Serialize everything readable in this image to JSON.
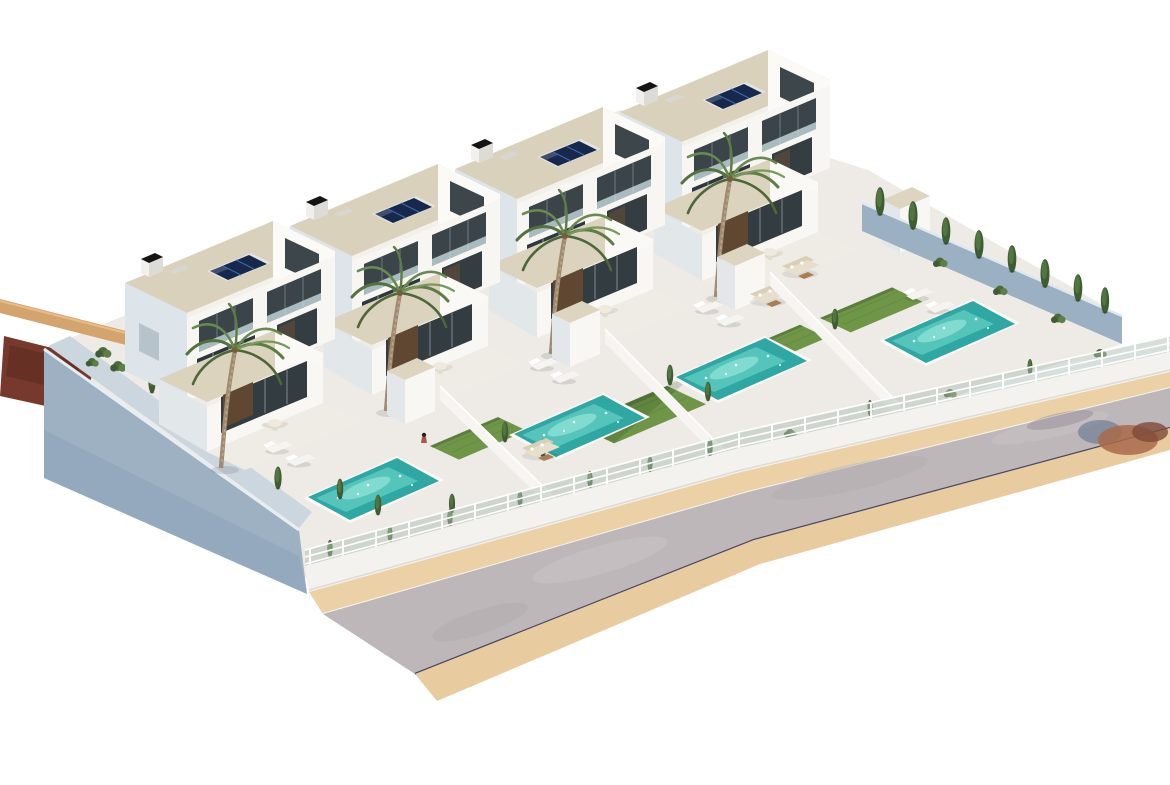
{
  "scene": {
    "type": "3d-architectural-render",
    "description": "Aerial 3D render of a row of four modern white two-storey villas with flat cream roofs, rooftop solar panels, private turquoise pools, lawns, palm trees, cypress hedges, white lattice fences, a blue-grey perimeter wall on the left and an asphalt street with sand-coloured sidewalks in front.",
    "villa_count": 4,
    "pool_count": 4,
    "palm_tree_count": 4,
    "solar_array_per_villa": 1,
    "features": [
      "flat roofs",
      "solar panels",
      "chimneys",
      "private pools",
      "sun loungers",
      "garden sofas",
      "lawns",
      "cypress trees",
      "white fences",
      "street with sidewalks"
    ]
  },
  "palette": {
    "background": "#ffffff",
    "ground": "#eeebe6",
    "roof": "#d9d1bc",
    "wall_sunlit": "#f7f6f2",
    "wall_bright": "#fbfaf7",
    "wall_shadow": "#dde4ea",
    "perimeter_wall_blue": "#9db1c3",
    "inner_wall_blue": "#ccd6df",
    "division_wall": "#f6f5f1",
    "back_wall_blue": "#9bb0c2",
    "front_wall": "#f3f2ee",
    "fence_mesh": "#aebfb3",
    "pool_deep": "#2fa7a3",
    "pool_light": "#6fd8cd",
    "pool_coping": "#fbfaf6",
    "lawn": "#6f9547",
    "lawn_shade": "#55763c",
    "asphalt": "#beb7b9",
    "sidewalk_upper": "#ecd0a6",
    "sidewalk_lower": "#e8cb9e",
    "curb": "#474761",
    "solar_panel": "#16294d",
    "solar_grid": "#3f66a6",
    "glass": "#3a4449",
    "glass_dark": "#2e373c",
    "palm_frond": "#5d7c46",
    "palm_trunk": "#a08b72",
    "cypress": "#3f5c33",
    "shrub": "#4d6b3b",
    "dirt": "#76392c",
    "access_road_tan": "#d5a36e",
    "gate_wood": "#53402d",
    "furniture": "#e7dfcc",
    "chimney_cap": "#141414"
  }
}
